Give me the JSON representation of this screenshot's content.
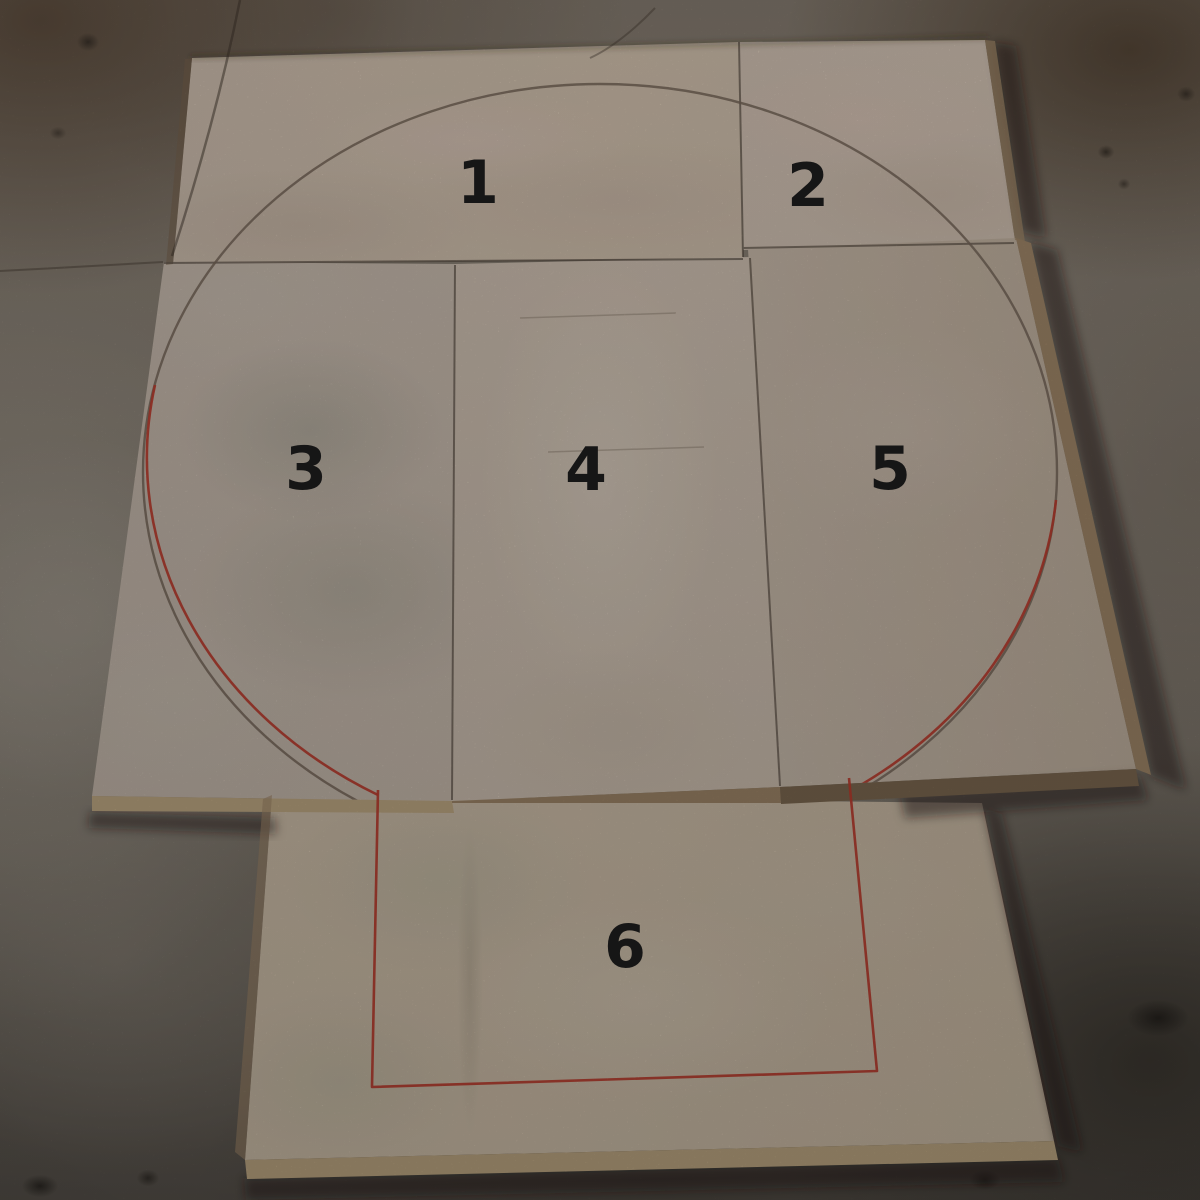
{
  "scene": {
    "panel_labels": [
      "1",
      "2",
      "3",
      "4",
      "5",
      "6"
    ],
    "colors": {
      "floor_base": "#847b70",
      "floor_dark": "#55504a",
      "panel_face": "#d1c2b4",
      "panel_face_warm": "#d6c6b2",
      "panel_edge": "#c6ae88",
      "panel_edge_side": "#a3896a",
      "panel_edge_dark": "#7d6950",
      "seam": "#51473d",
      "pencil": "#77675a",
      "marker_red": "#c23a2b",
      "label_ink": "#161616"
    }
  }
}
